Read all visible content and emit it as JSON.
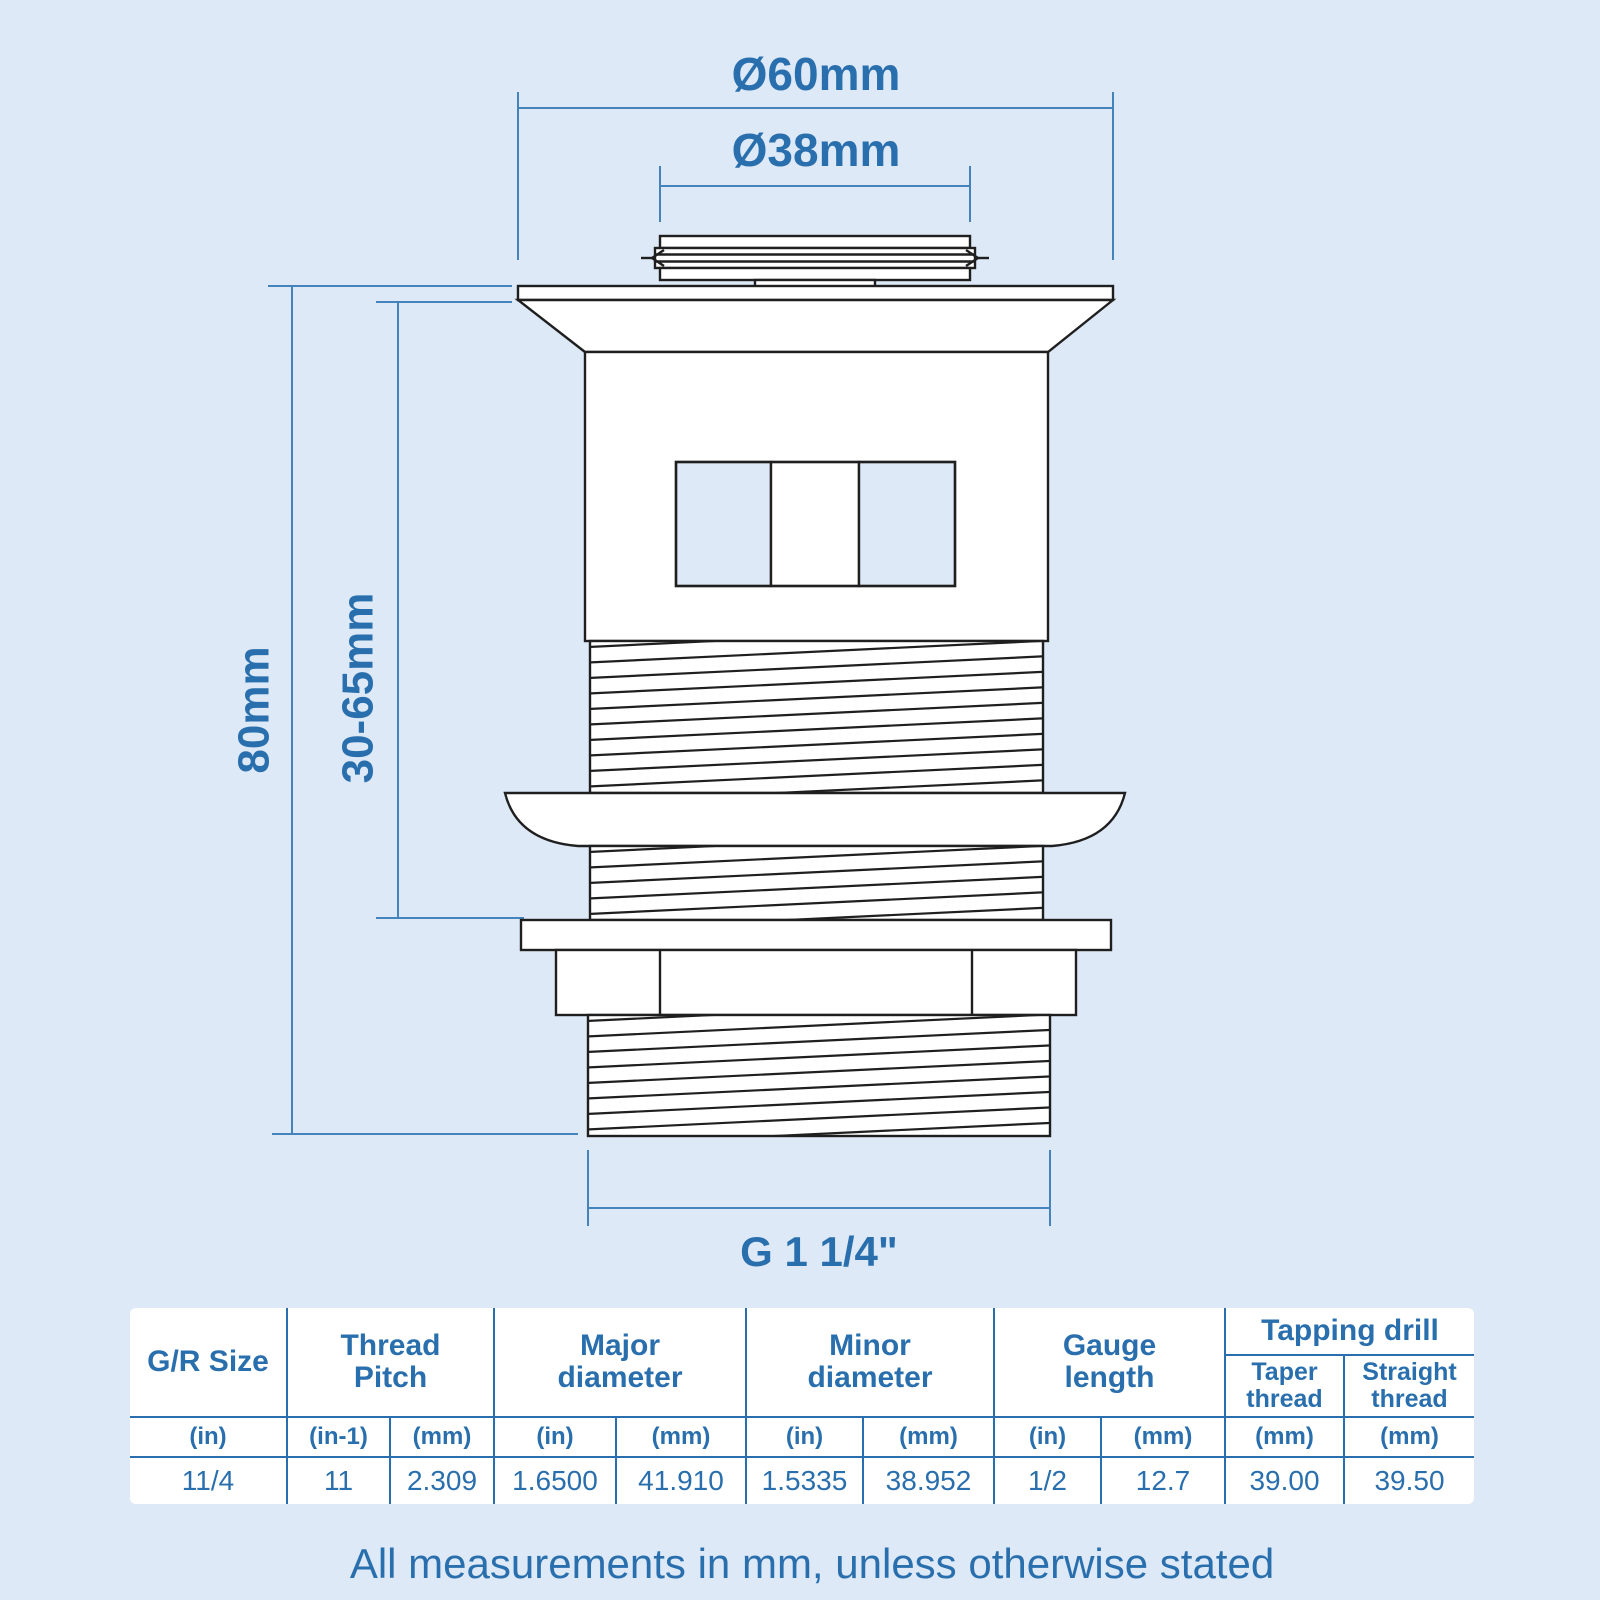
{
  "diagram": {
    "dims": {
      "top_outer_diameter": "Ø60mm",
      "top_inner_diameter": "Ø38mm",
      "overall_height": "80mm",
      "adjustable_reach": "30-65mm",
      "thread_size": "G 1 1/4\""
    }
  },
  "table": {
    "col_groups": [
      "G/R Size",
      "Thread Pitch",
      "Major diameter",
      "Minor diameter",
      "Gauge length",
      "Tapping drill"
    ],
    "tapping_sub": [
      "Taper thread",
      "Straight thread"
    ],
    "units": [
      "(in)",
      "(in-1)",
      "(mm)",
      "(in)",
      "(mm)",
      "(in)",
      "(mm)",
      "(in)",
      "(mm)",
      "(mm)",
      "(mm)"
    ],
    "values": [
      "11/4",
      "11",
      "2.309",
      "1.6500",
      "41.910",
      "1.5335",
      "38.952",
      "1/2",
      "12.7",
      "39.00",
      "39.50"
    ]
  },
  "footer": {
    "note": "All measurements in mm, unless otherwise stated"
  },
  "colors": {
    "background": "#dde9f6",
    "accent_text": "#2a6fad",
    "dimension_line": "#4484ba",
    "outline": "#1f1f1f",
    "panel": "#ffffff"
  }
}
